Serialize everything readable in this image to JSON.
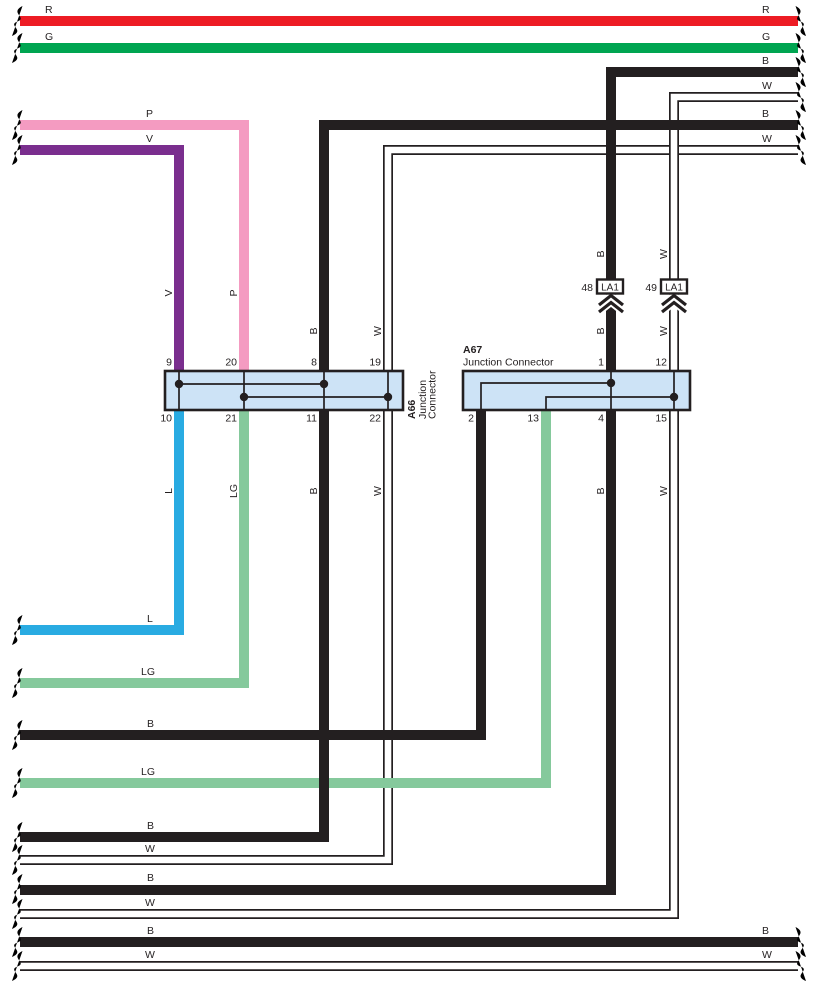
{
  "page": {
    "background": "#ffffff"
  },
  "colors": {
    "black": "#231f20",
    "red": "#ed1c24",
    "green": "#00a551",
    "pink": "#f49bc1",
    "violet": "#7a2e8e",
    "blue": "#29abe2",
    "light_green": "#85c99c",
    "white": "#ffffff",
    "connector_fill": "#cde3f6"
  },
  "wire_codes": {
    "R": "R",
    "G": "G",
    "B": "B",
    "W": "W",
    "P": "P",
    "V": "V",
    "L": "L",
    "LG": "LG"
  },
  "connector_a66": {
    "id": "A66",
    "name_line1": "Junction",
    "name_line2": "Connector",
    "pins": {
      "p9": "9",
      "p20": "20",
      "p8": "8",
      "p19": "19",
      "p10": "10",
      "p21": "21",
      "p11": "11",
      "p22": "22"
    }
  },
  "connector_a67": {
    "id": "A67",
    "name": "Junction Connector",
    "pins": {
      "p1": "1",
      "p12": "12",
      "p2": "2",
      "p13": "13",
      "p4": "4",
      "p15": "15"
    }
  },
  "la1_references": {
    "left": {
      "pin": "48",
      "label": "LA1"
    },
    "right": {
      "pin": "49",
      "label": "LA1"
    }
  }
}
